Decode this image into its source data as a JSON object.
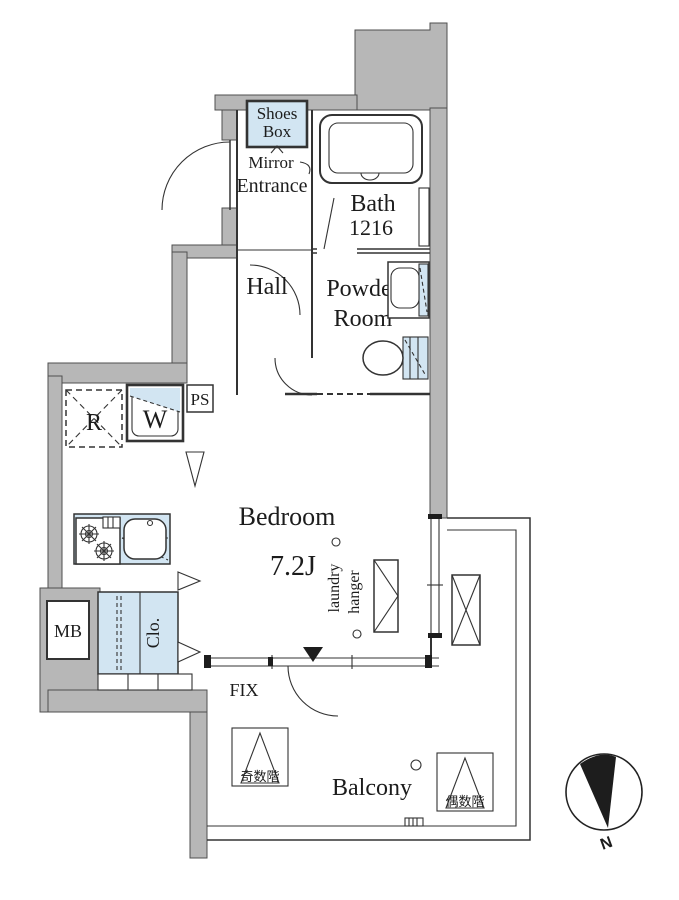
{
  "floorplan": {
    "rooms": {
      "shoes_box_l1": "Shoes",
      "shoes_box_l2": "Box",
      "mirror": "Mirror",
      "entrance": "Entrance",
      "bath_l1": "Bath",
      "bath_l2": "1216",
      "hall": "Hall",
      "powder_l1": "Powder",
      "powder_l2": "Room",
      "bedroom": "Bedroom",
      "bedroom_size": "7.2J",
      "closet": "Clo.",
      "balcony": "Balcony"
    },
    "equipment": {
      "refrigerator": "R",
      "washer": "W",
      "pipe_space": "PS",
      "meter_box": "MB",
      "laundry_l1": "laundry",
      "laundry_l2": "hanger",
      "fix_window": "FIX"
    },
    "markers": {
      "odd_floor": "奇数階",
      "even_floor": "偶数階",
      "north": "N"
    },
    "colors": {
      "wall_gray": "#b7b7b7",
      "fixture_blue": "#d2e5f2",
      "line_dark": "#333333"
    }
  }
}
